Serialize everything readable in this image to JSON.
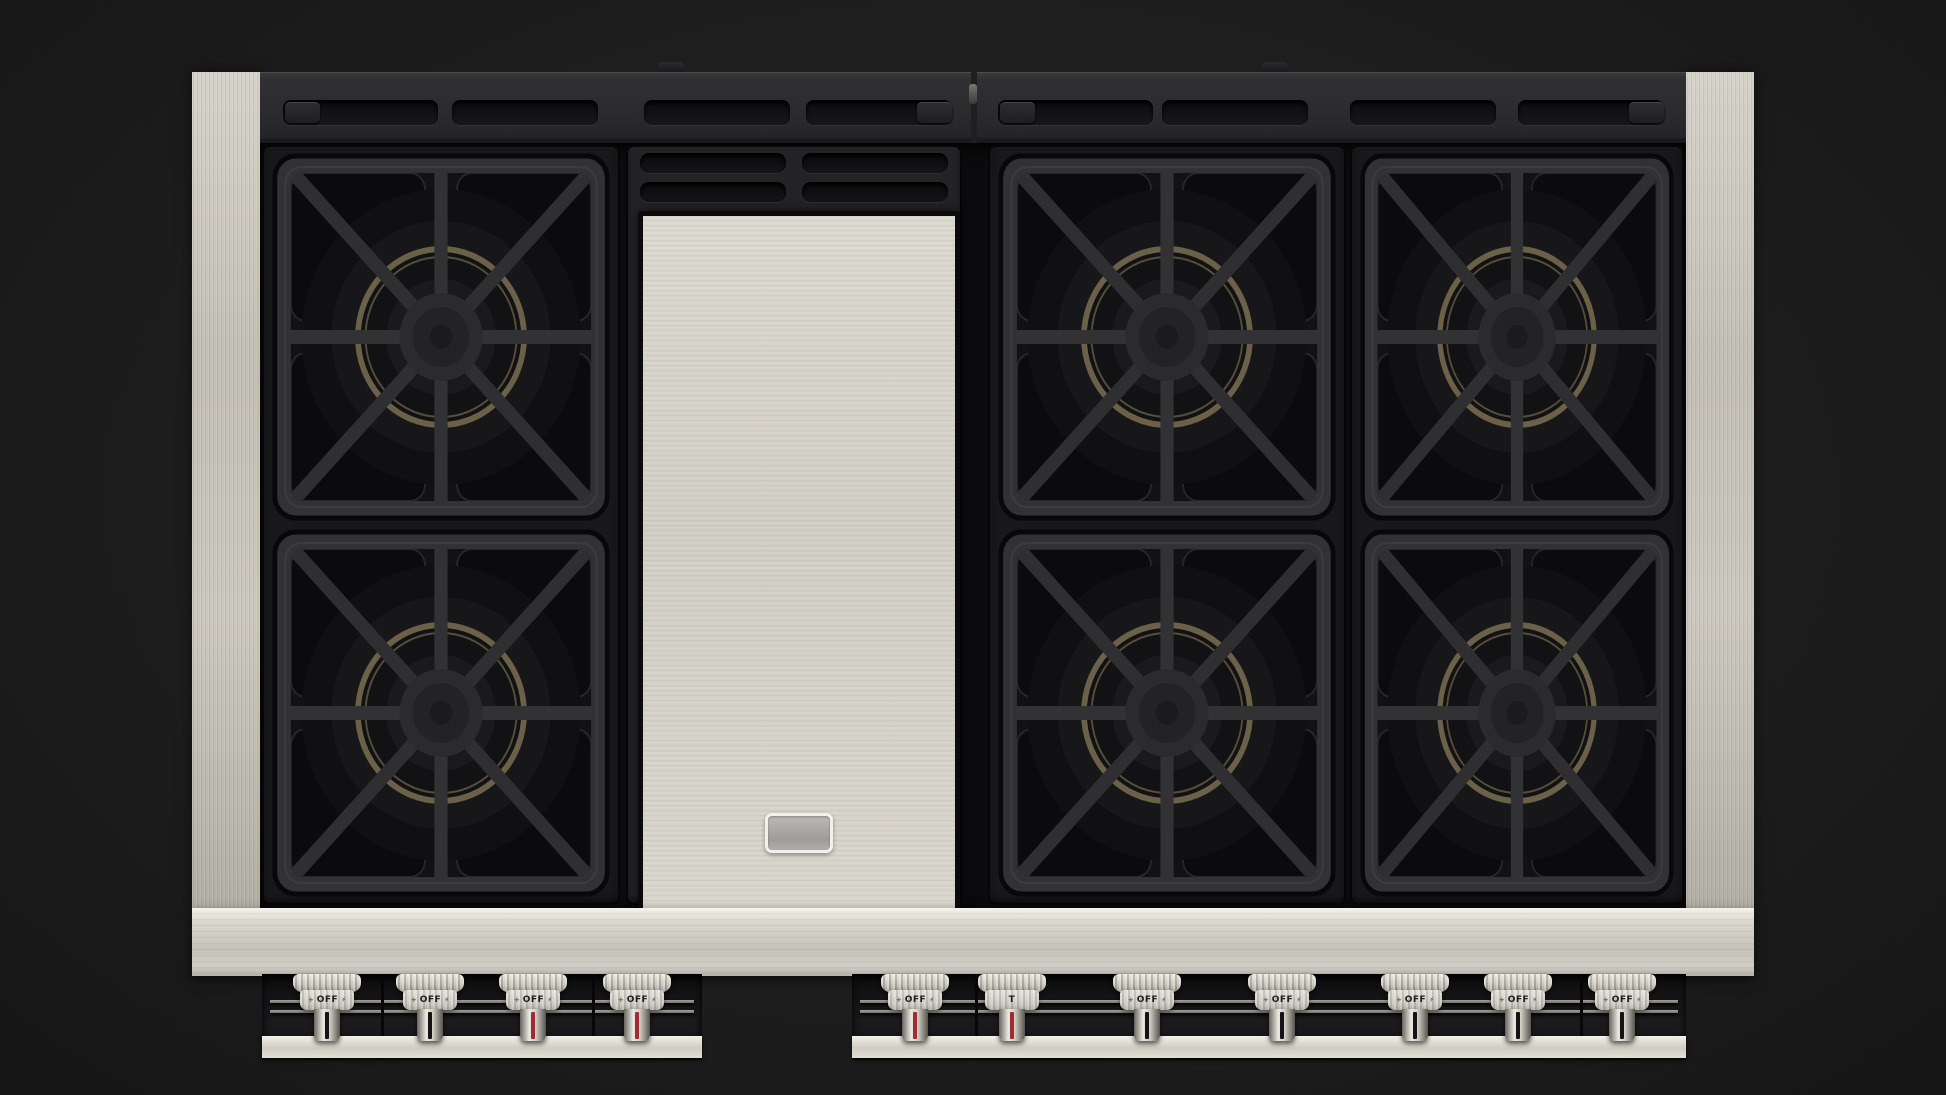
{
  "scene": {
    "subject": "six-burner gas range cooktop with center griddle, top view",
    "visible_text_note": "only knob markings are visible"
  },
  "colors": {
    "background": "#1e1e1e",
    "stainless": "#cdcac1",
    "trim_black": "#2d2d2f",
    "well_black": "#0b0b0d",
    "grate_gray": "#323234",
    "brass_ring": "#6b6148",
    "indicator_black": "#141417",
    "indicator_red": "#a12b33",
    "badge_chrome": "#f1f0ec"
  },
  "counts": {
    "burners": 6,
    "burner_modules": 3,
    "knobs": 11,
    "top_vent_slots_per_half": 4,
    "griddle_vent_slots": 4
  },
  "griddle": {
    "badge_text": ""
  },
  "knob_row": {
    "left_panel": [
      {
        "id": "knob-1",
        "label": "OFF",
        "indicator": "black",
        "left_mark": "+",
        "right_mark": "⚡"
      },
      {
        "id": "knob-2",
        "label": "OFF",
        "indicator": "black",
        "left_mark": "+",
        "right_mark": "⚡"
      },
      {
        "id": "knob-3",
        "label": "OFF",
        "indicator": "red",
        "left_mark": "+",
        "right_mark": "⚡"
      },
      {
        "id": "knob-4",
        "label": "OFF",
        "indicator": "red",
        "left_mark": "+",
        "right_mark": "⚡"
      }
    ],
    "right_panel": [
      {
        "id": "knob-5",
        "label": "OFF",
        "indicator": "red",
        "left_mark": "+",
        "right_mark": "⚡"
      },
      {
        "id": "knob-griddle",
        "label": "T",
        "indicator": "red",
        "left_mark": "",
        "right_mark": ""
      },
      {
        "id": "knob-6",
        "label": "OFF",
        "indicator": "black",
        "left_mark": "+",
        "right_mark": "⚡"
      },
      {
        "id": "knob-7",
        "label": "OFF",
        "indicator": "black",
        "left_mark": "+",
        "right_mark": "⚡"
      },
      {
        "id": "knob-8",
        "label": "OFF",
        "indicator": "black",
        "left_mark": "+",
        "right_mark": "⚡"
      },
      {
        "id": "knob-9",
        "label": "OFF",
        "indicator": "black",
        "left_mark": "+",
        "right_mark": "⚡"
      },
      {
        "id": "knob-10",
        "label": "OFF",
        "indicator": "black",
        "left_mark": "+",
        "right_mark": "⚡"
      }
    ]
  }
}
